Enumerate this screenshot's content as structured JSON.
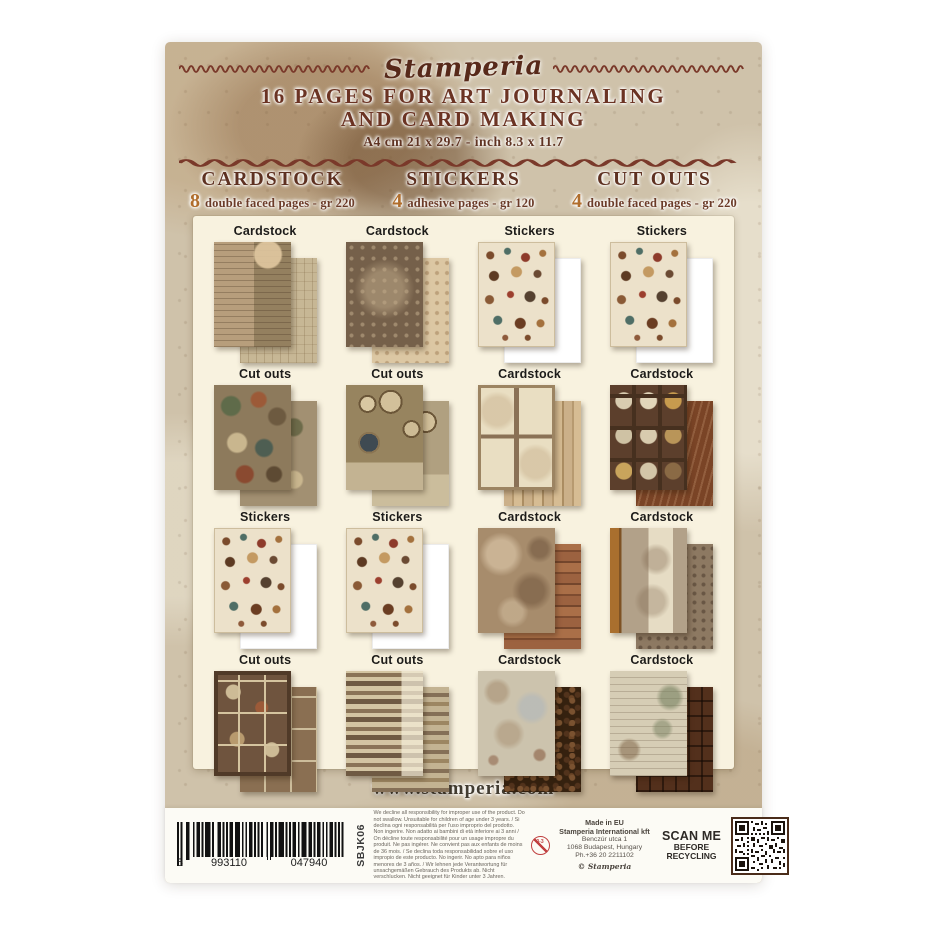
{
  "package": {
    "brand": "Stamperia",
    "title_line1": "16 PAGES FOR ART JOURNALING",
    "title_line2": "AND CARD MAKING",
    "size_line": "A4 cm 21 x 29.7 - inch 8.3 x 11.7",
    "columns": [
      {
        "count": "8",
        "name": "CARDSTOCK",
        "desc": "double faced pages - gr 220"
      },
      {
        "count": "4",
        "name": "STICKERS",
        "desc": "adhesive pages - gr 120"
      },
      {
        "count": "4",
        "name": "CUT OUTS",
        "desc": "double faced pages - gr 220"
      }
    ],
    "grid": {
      "cells": [
        {
          "label": "Cardstock"
        },
        {
          "label": "Cardstock"
        },
        {
          "label": "Stickers"
        },
        {
          "label": "Stickers"
        },
        {
          "label": "Cut outs"
        },
        {
          "label": "Cut outs"
        },
        {
          "label": "Cardstock"
        },
        {
          "label": "Cardstock"
        },
        {
          "label": "Stickers"
        },
        {
          "label": "Stickers"
        },
        {
          "label": "Cardstock"
        },
        {
          "label": "Cardstock"
        },
        {
          "label": "Cut outs"
        },
        {
          "label": "Cut outs"
        },
        {
          "label": "Cardstock"
        },
        {
          "label": "Cardstock"
        }
      ]
    },
    "website": "www.stamperia.com",
    "bottom": {
      "barcode": [
        "5",
        "993110",
        "047940"
      ],
      "sku": "SBJK06",
      "disclaimer": "We decline all responsibility for improper use of the product. Do not swallow. Unsuitable for children of age under 3 years. / Si declina ogni responsabilità per l'uso improprio del prodotto. Non ingerire. Non adatto ai bambini di età inferiore ai 3 anni / On décline toute responsabilité pour un usage impropre du produit. Ne pas ingérer. Ne convient pas aux enfants de moins de 36 mois. / Se declina toda responsabilidad sobre el uso impropio de este producto. No ingerir. No apto para niños menores de 3 años. / Wir lehnen jede Verantwortung für unsachgemäßen Gebrauch des Produkts ab. Nicht verschlucken. Nicht geeignet für Kinder unter 3 Jahren.",
      "age_label": "0-3",
      "address": [
        "Made in EU",
        "Stamperia International kft",
        "Benczúr utca 1",
        "1068 Budapest, Hungary",
        "Ph.+36 20 2211102"
      ],
      "copyright_symbol": "©",
      "copyright_name": "Stamperia",
      "scan_me": [
        "SCAN ME",
        "BEFORE",
        "RECYCLING"
      ]
    },
    "colors": {
      "header_brown": "#6b3323",
      "accent_gold": "#b06d2c",
      "panel_cream": "#f8f2df",
      "paper_bg": "#cfc2aa",
      "wave_line": "#7a392a"
    }
  }
}
